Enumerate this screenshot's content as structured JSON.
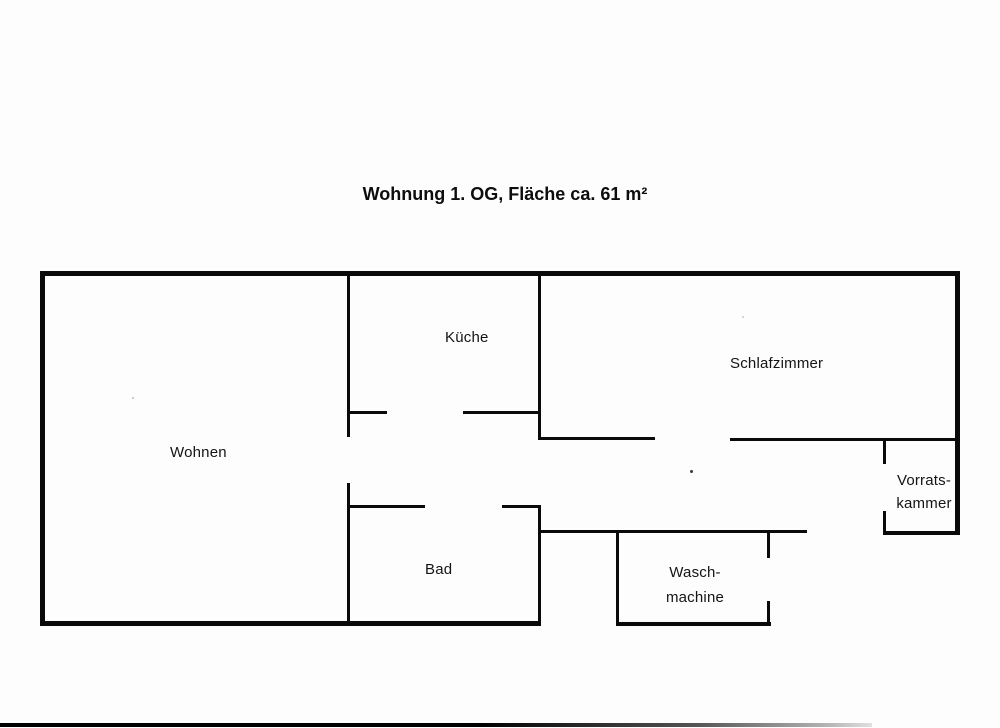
{
  "title": "Wohnung 1. OG, Fläche ca. 61 m²",
  "rooms": {
    "wohnen": {
      "label": "Wohnen"
    },
    "kueche": {
      "label": "Küche"
    },
    "schlafzimmer": {
      "label": "Schlafzimmer"
    },
    "bad": {
      "label": "Bad"
    },
    "waschmachine": {
      "line1": "Wasch-",
      "line2": "machine"
    },
    "vorratskammer": {
      "line1": "Vorrats-",
      "line2": "kammer"
    }
  },
  "colors": {
    "wall": "#0a0a0a",
    "text": "#141414",
    "paper": "#fdfdfd"
  }
}
